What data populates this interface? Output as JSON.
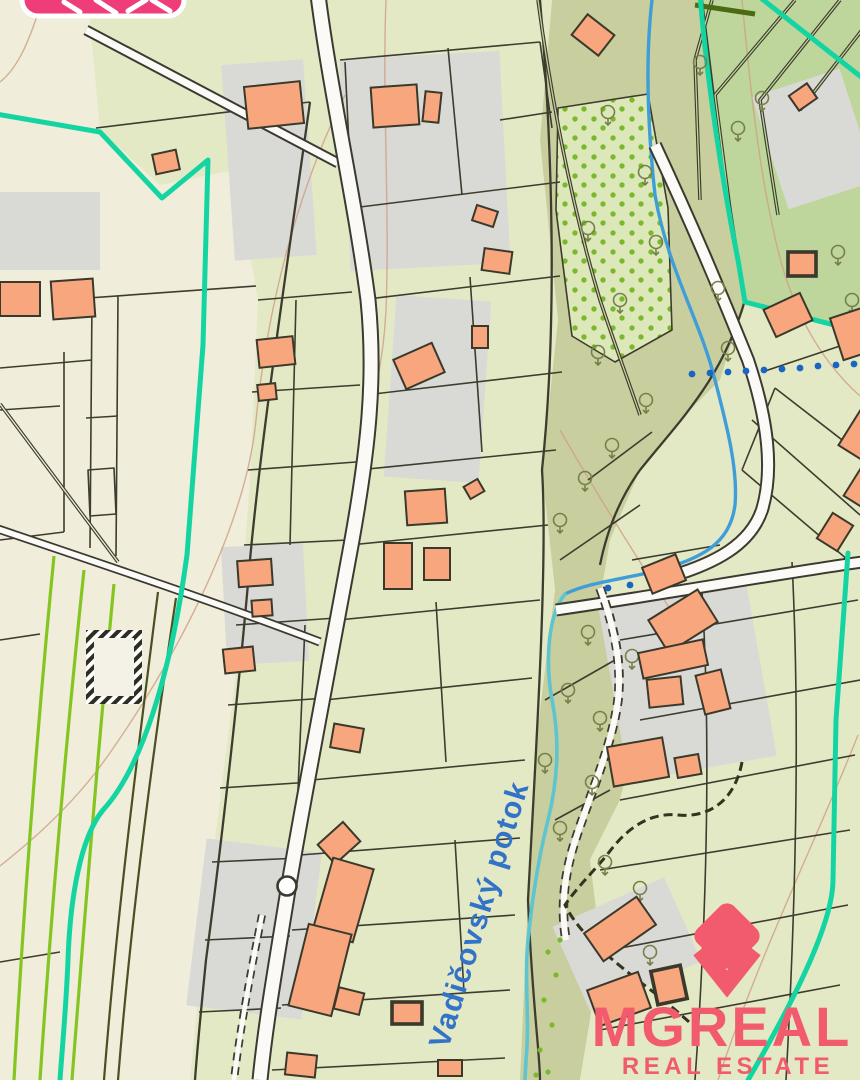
{
  "map": {
    "stream_label": "Vadičovský potok",
    "type": "cadastral-map",
    "symbols": [
      "stream",
      "trees",
      "orchard-dots",
      "road-circle",
      "hatched-building"
    ]
  },
  "watermark": {
    "brand": "MGREAL",
    "tagline": "REAL ESTATE"
  },
  "colors": {
    "map-cream": "#f0edda",
    "map-green": "#e4e9c5",
    "map-olive": "#c9ce9e",
    "map-fields": "#bed59b",
    "map-orchard": "#dde8ba",
    "yard-gray": "#d9d9d6",
    "building-fill": "#f7a67d",
    "building-stroke": "#3a392b",
    "line": "#3d3c2e",
    "road-casing": "#3b3a31",
    "road-fill": "#fbfaf6",
    "stream-blue": "#3f9ed8",
    "stream-cyan": "#5ec4cf",
    "teal": "#14d5a2",
    "dot-blue": "#1966c2",
    "lime": "#84c522",
    "contour": "#cfa287",
    "tree": "#75804a",
    "orchard-dot": "#7cb82e",
    "label-blue": "#3273c8",
    "brand-pink": "#ee3d78",
    "brand-coral": "#f25b6e"
  }
}
